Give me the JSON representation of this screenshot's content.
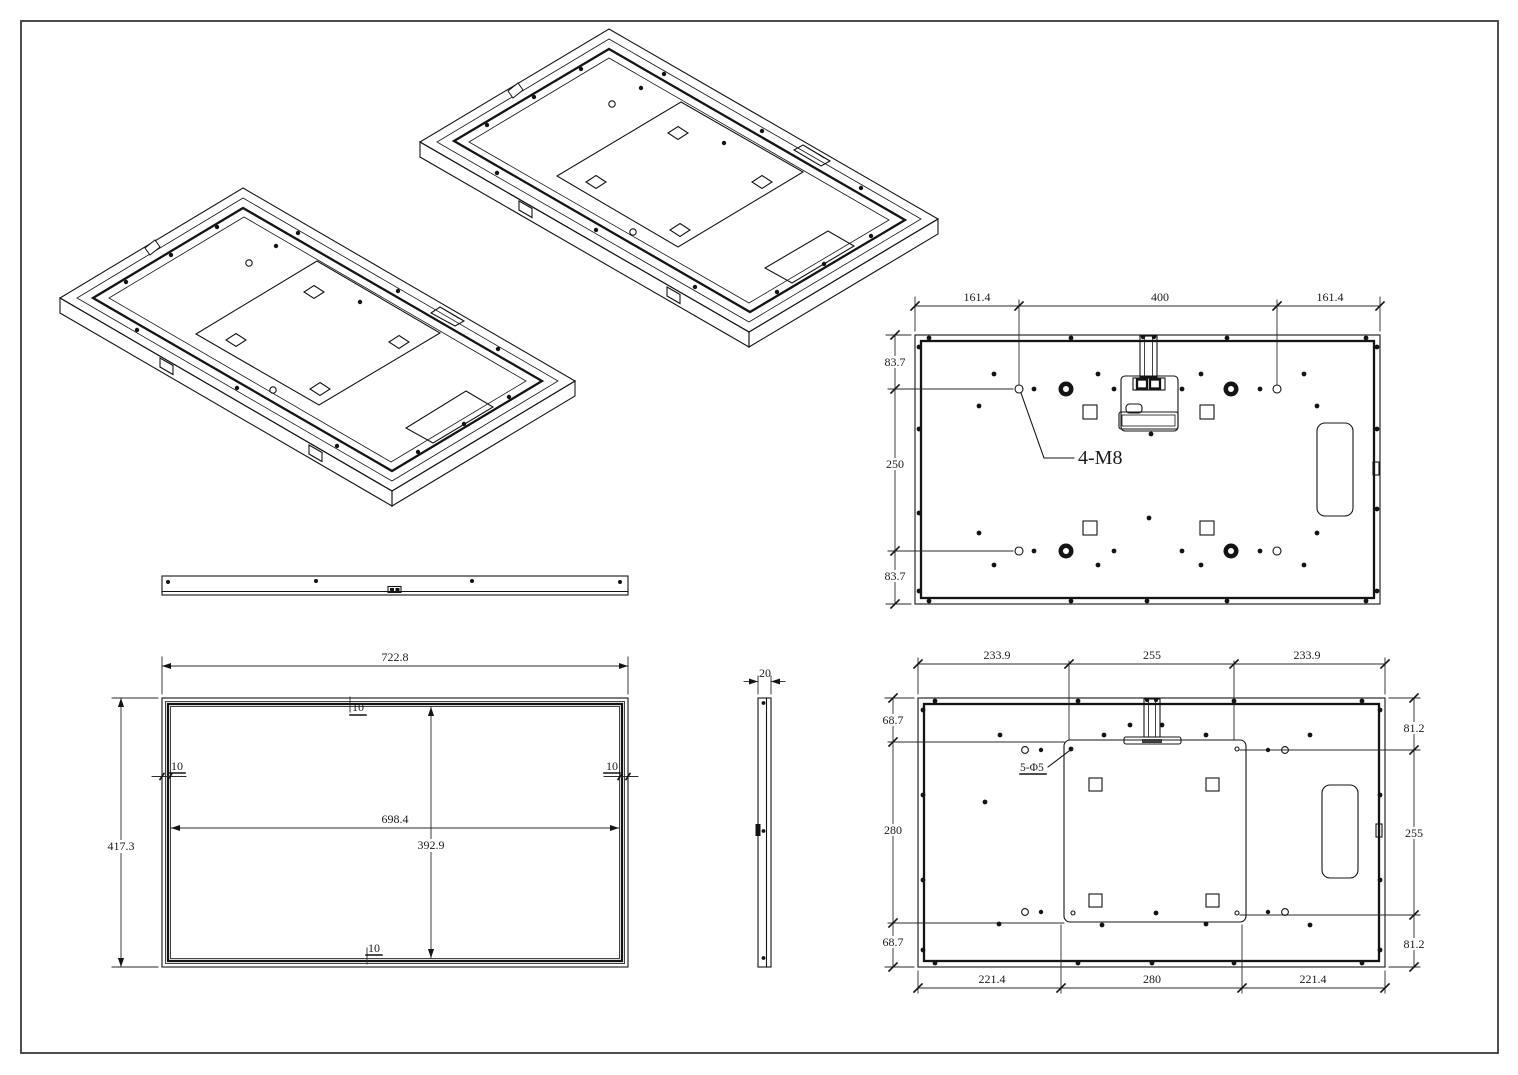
{
  "palette": {
    "background": "#ffffff",
    "line": "#141414",
    "text": "#1b1b1b"
  },
  "back_view_top": {
    "dims_top": [
      "161.4",
      "400",
      "161.4"
    ],
    "dims_left": [
      "83.7",
      "250",
      "83.7"
    ],
    "thread_label": "4-M8"
  },
  "front_view": {
    "dim_outer_width": "722.8",
    "dim_outer_height": "417.3",
    "dim_inner_width": "698.4",
    "dim_inner_height": "392.9",
    "dim_bezel_top": "10",
    "dim_bezel_left": "10",
    "dim_bezel_right": "10",
    "dim_bezel_bottom": "10"
  },
  "side_view": {
    "dim_thickness": "20"
  },
  "back_view_bottom": {
    "dims_top": [
      "233.9",
      "255",
      "233.9"
    ],
    "dims_left": [
      "68.7",
      "280",
      "68.7"
    ],
    "dims_right": [
      "81.2",
      "255",
      "81.2"
    ],
    "dims_bottom": [
      "221.4",
      "280",
      "221.4"
    ],
    "hole_label": "5-Φ5"
  }
}
